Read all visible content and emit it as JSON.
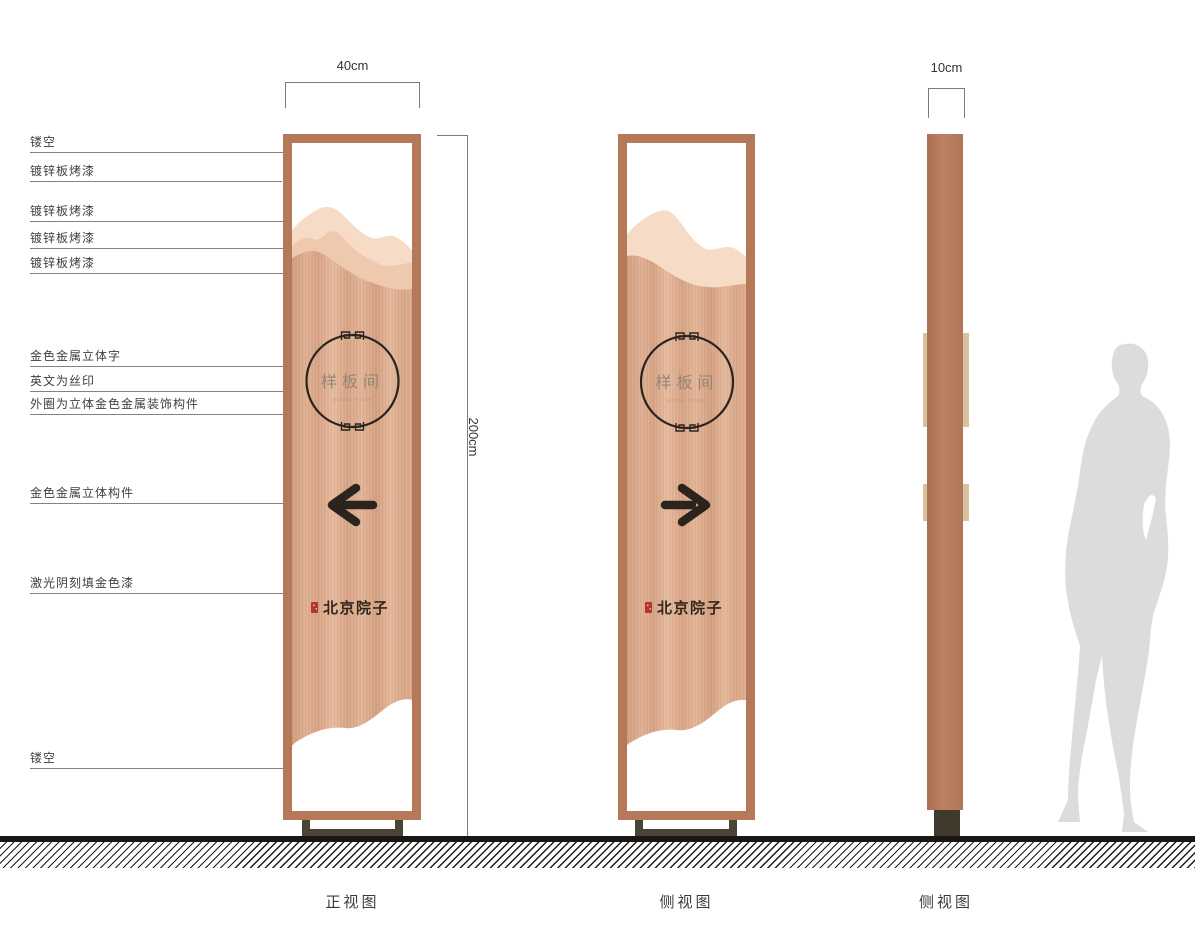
{
  "callouts": [
    {
      "label": "镂空"
    },
    {
      "label": "镀锌板烤漆"
    },
    {
      "label": "镀锌板烤漆"
    },
    {
      "label": "镀锌板烤漆"
    },
    {
      "label": "镀锌板烤漆"
    },
    {
      "label": "金色金属立体字"
    },
    {
      "label": "英文为丝印"
    },
    {
      "label": "外圈为立体金色金属装饰构件"
    },
    {
      "label": "金色金属立体构件"
    },
    {
      "label": "激光阴刻填金色漆"
    },
    {
      "label": "镂空"
    }
  ],
  "dimensions": {
    "front_width": "40cm",
    "height": "200cm",
    "side_width": "10cm"
  },
  "views": {
    "front": {
      "caption": "正视图"
    },
    "side": {
      "caption": "侧视图"
    },
    "side_thin": {
      "caption": "侧视图"
    }
  },
  "sign": {
    "circle_text": "样板间",
    "english_subtext": "MODEL ROOM",
    "logo_text": "北京院子"
  },
  "colors": {
    "frame": "#b5795a",
    "wood_base": "#dcab8d",
    "mountain_light": "#f6dcc6",
    "mountain_mid": "#efc9ae",
    "dark_detail": "#2b241e",
    "stand": "#4a4435",
    "silhouette": "#dcdcde",
    "seal_red": "#b5352b",
    "tan_block": "#d8c19e"
  }
}
